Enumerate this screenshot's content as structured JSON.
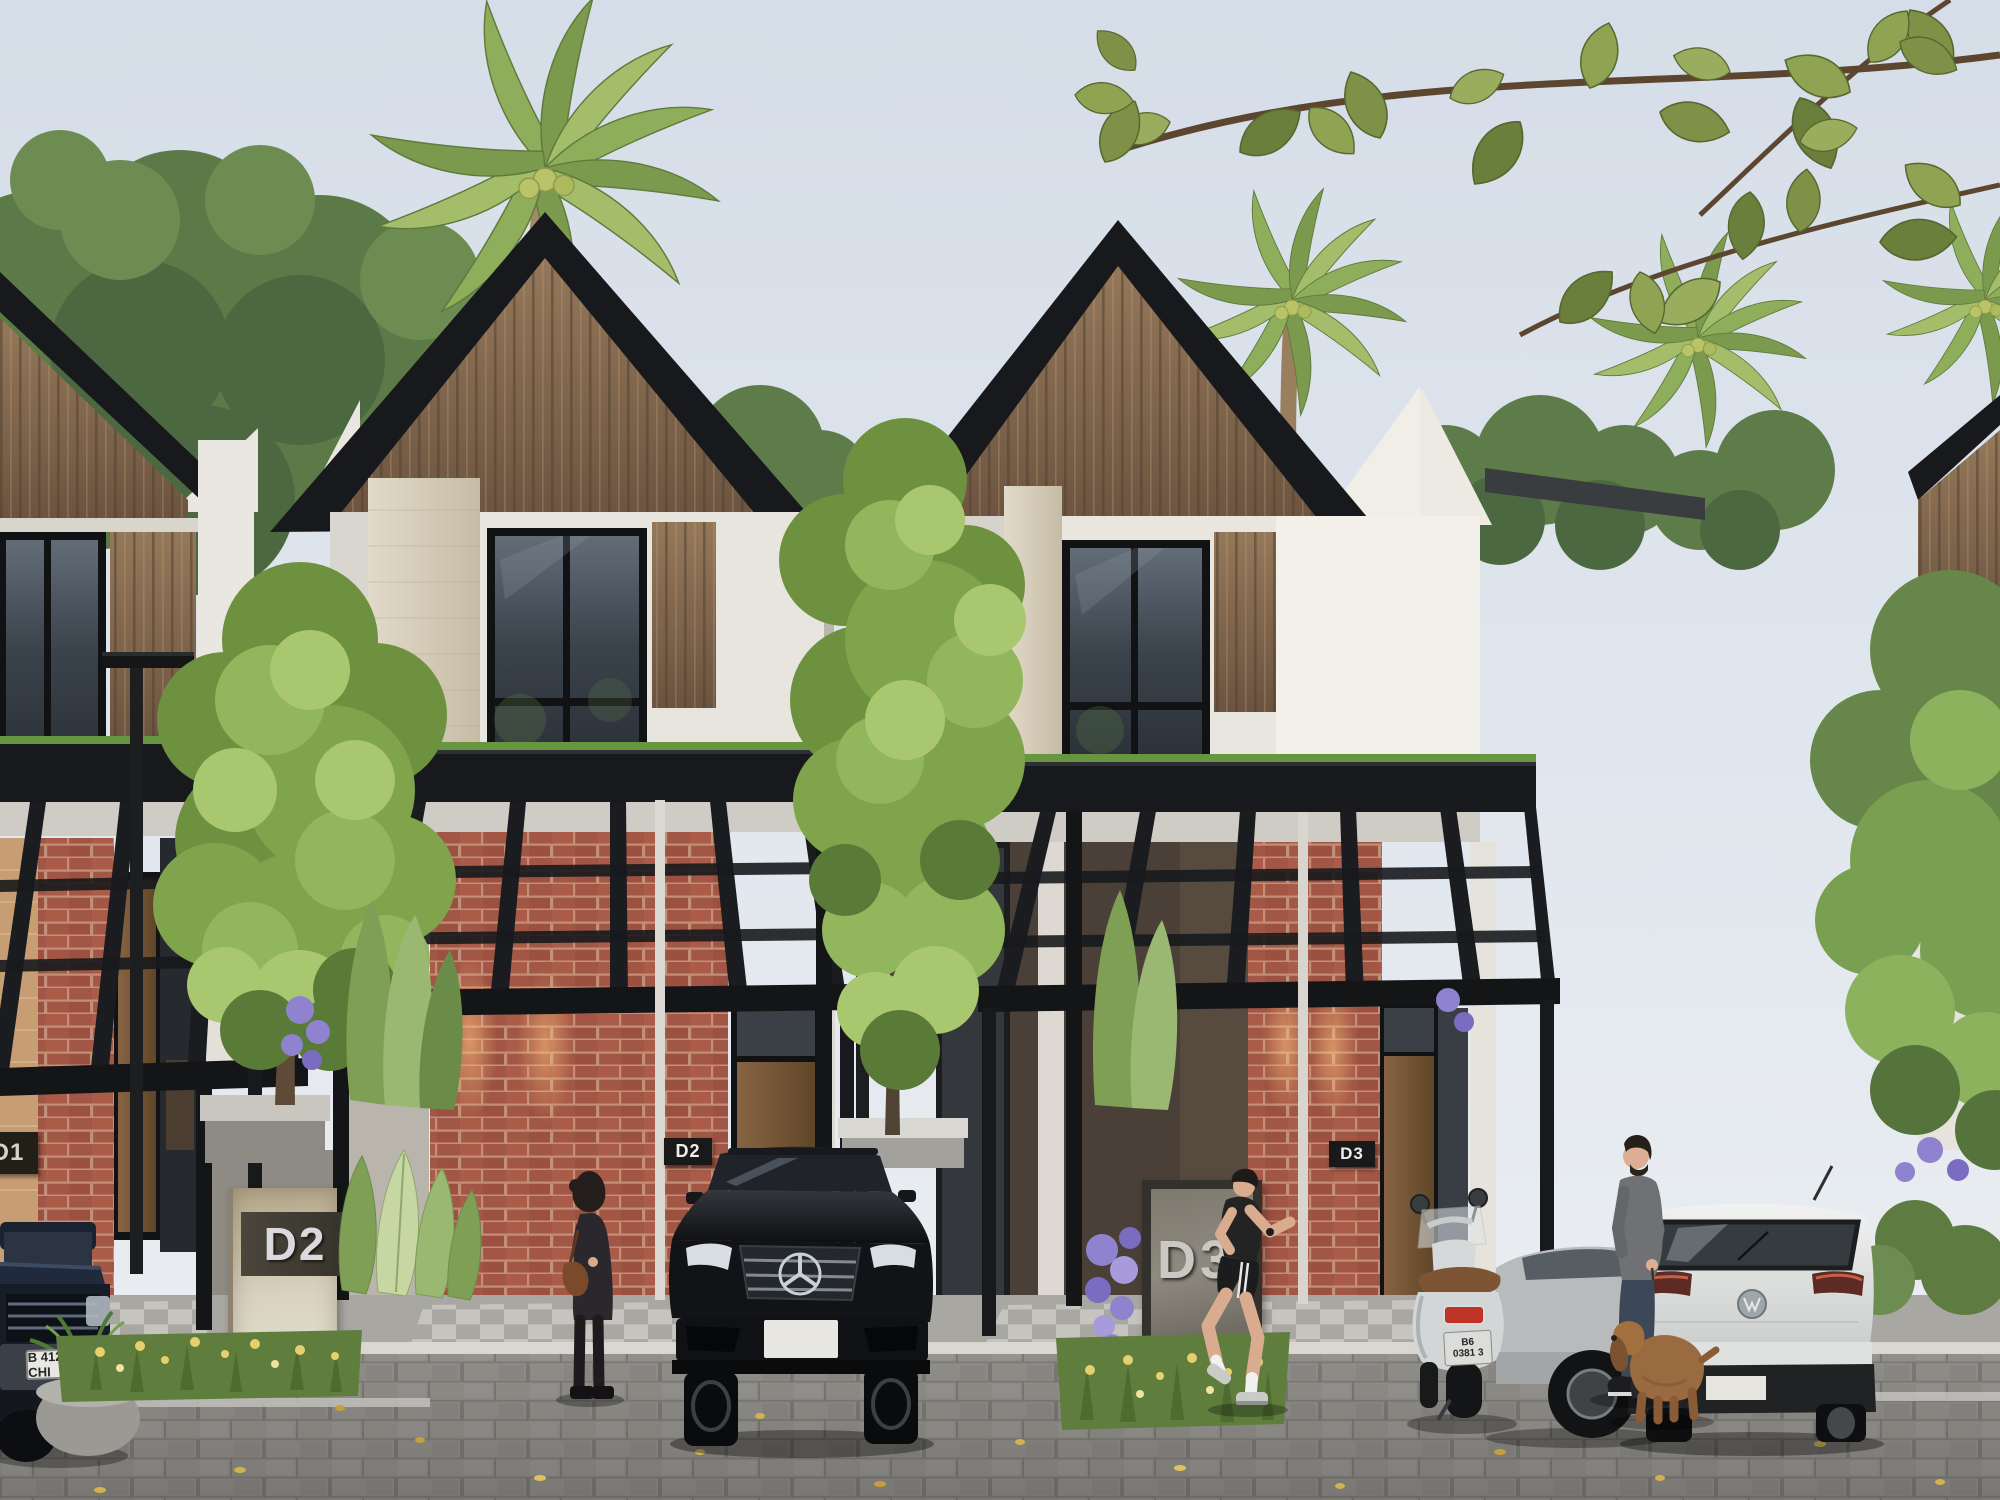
{
  "meta": {
    "title": "Modern two-storey townhouse row - exterior architectural rendering",
    "image_type": "3d-architectural-visualization"
  },
  "signs": {
    "d1_wall_plaque": "D1",
    "d2_wall_plaque": "D2",
    "d3_wall_plaque": "D3",
    "d2_monument": "D2",
    "d3_monument": "D3"
  },
  "license_plates": {
    "pickup_truck": "B 412 CHI",
    "scooter_line1": "B6",
    "scooter_line2": "0381 3",
    "mercedes_front": ""
  },
  "icons": [
    "mercedes-star-icon",
    "vw-badge-icon",
    "street-lamp-icon"
  ],
  "palette": {
    "sky": "#dee6ee",
    "roof_trim": "#17191c",
    "gable_wood": "#84684c",
    "white_wall": "#eceae3",
    "stone_column": "#d8cfbd",
    "brick": "#a25645",
    "carport_steel": "#141517",
    "sedum_roof_edge": "#679540",
    "foliage_bright": "#7fa44c",
    "foliage_dark": "#5a7a38",
    "hydrangea_purple": "#8f83cf",
    "flower_yellow": "#e6d06e",
    "pavement": "#96948f"
  },
  "scene_objects": {
    "vehicles": [
      "dark pickup truck",
      "black Mercedes-Benz sedan",
      "white Vespa scooter",
      "silver hatchback",
      "white Volkswagen hatchback"
    ],
    "people": [
      "woman with handbag",
      "male jogger",
      "man walking dog"
    ],
    "animals": [
      "brown cocker spaniel"
    ]
  }
}
